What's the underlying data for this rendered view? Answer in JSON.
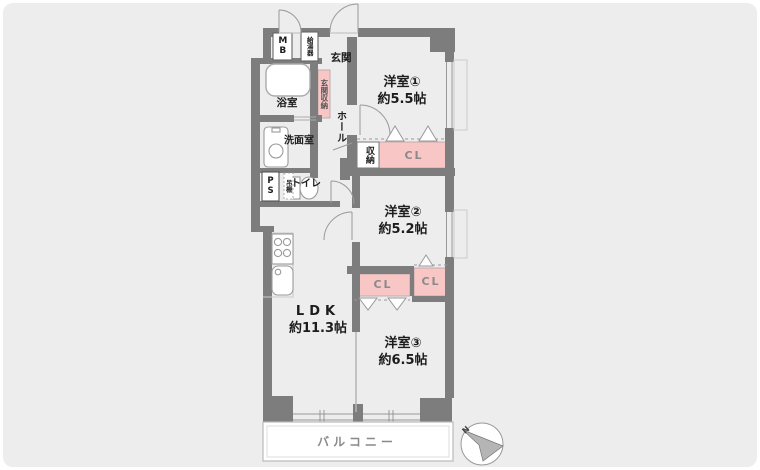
{
  "rooms": {
    "yoshitsu1": {
      "name": "洋室①",
      "size": "約5.5帖"
    },
    "yoshitsu2": {
      "name": "洋室②",
      "size": "約5.2帖"
    },
    "yoshitsu3": {
      "name": "洋室③",
      "size": "約6.5帖"
    },
    "ldk": {
      "name": "LDK",
      "size": "約11.3帖"
    },
    "genkan": "玄関",
    "hall": "ホール",
    "bathroom": "浴室",
    "washroom": "洗面室",
    "toilet": "トイレ",
    "balcony": "バルコニー"
  },
  "storage": {
    "genkan_shuno": "玄関収納",
    "shuno": "収納",
    "cl_1": "CL",
    "cl_2": "CL",
    "cl_3": "CL",
    "tana": "吊棚"
  },
  "utility": {
    "mb": "MB",
    "kyutoki": "給湯器",
    "ps": "PS"
  },
  "compass": {
    "north": "N"
  },
  "colors": {
    "wall": "#7d7d7d",
    "closet_pink": "#f9c6c6",
    "canvas": "#ededed",
    "line": "#999999"
  }
}
